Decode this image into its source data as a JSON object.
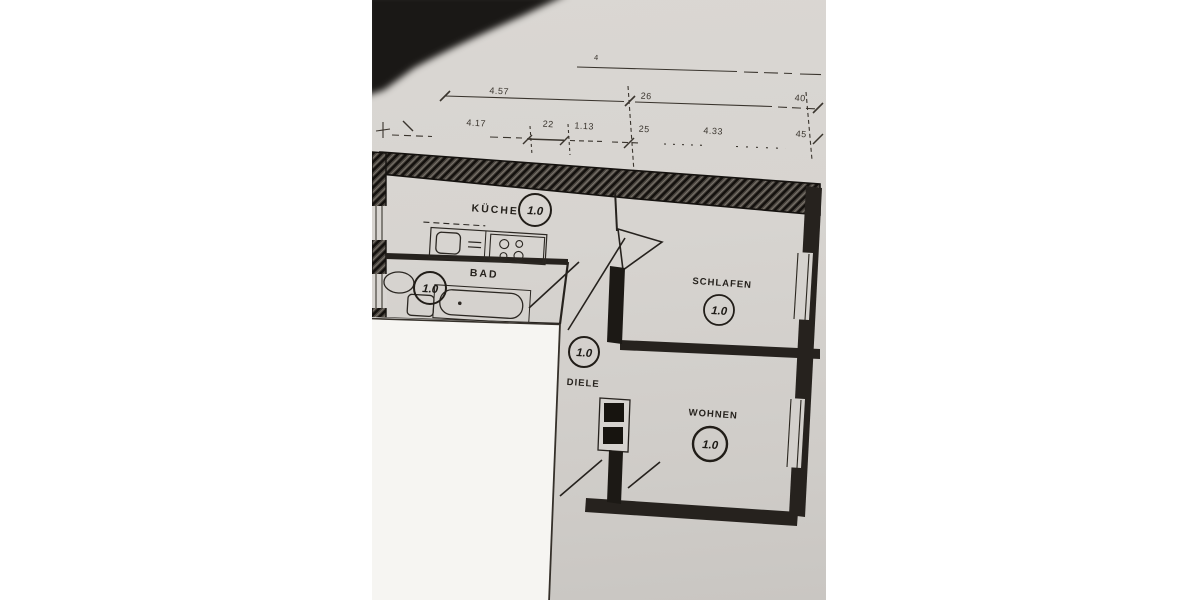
{
  "photo": {
    "paper_color": "#d6d3cf",
    "overlay_color": "#f6f5f2",
    "shadow_color": "#1a1816",
    "ink_color": "#26221e"
  },
  "plan": {
    "rooms": [
      {
        "name": "KÜCHE",
        "number": "1.0"
      },
      {
        "name": "BAD",
        "number": "1.0"
      },
      {
        "name": "SCHLAFEN",
        "number": "1.0"
      },
      {
        "name": "DIELE",
        "number": "1.0"
      },
      {
        "name": "WOHNEN",
        "number": "1.0"
      }
    ],
    "dimensions": {
      "overall_label": "4",
      "upper_chain": [
        "4.57",
        "26",
        "40"
      ],
      "lower_chain": [
        "4.17",
        "22",
        "1.13",
        "25",
        "4.33",
        "45"
      ]
    }
  }
}
